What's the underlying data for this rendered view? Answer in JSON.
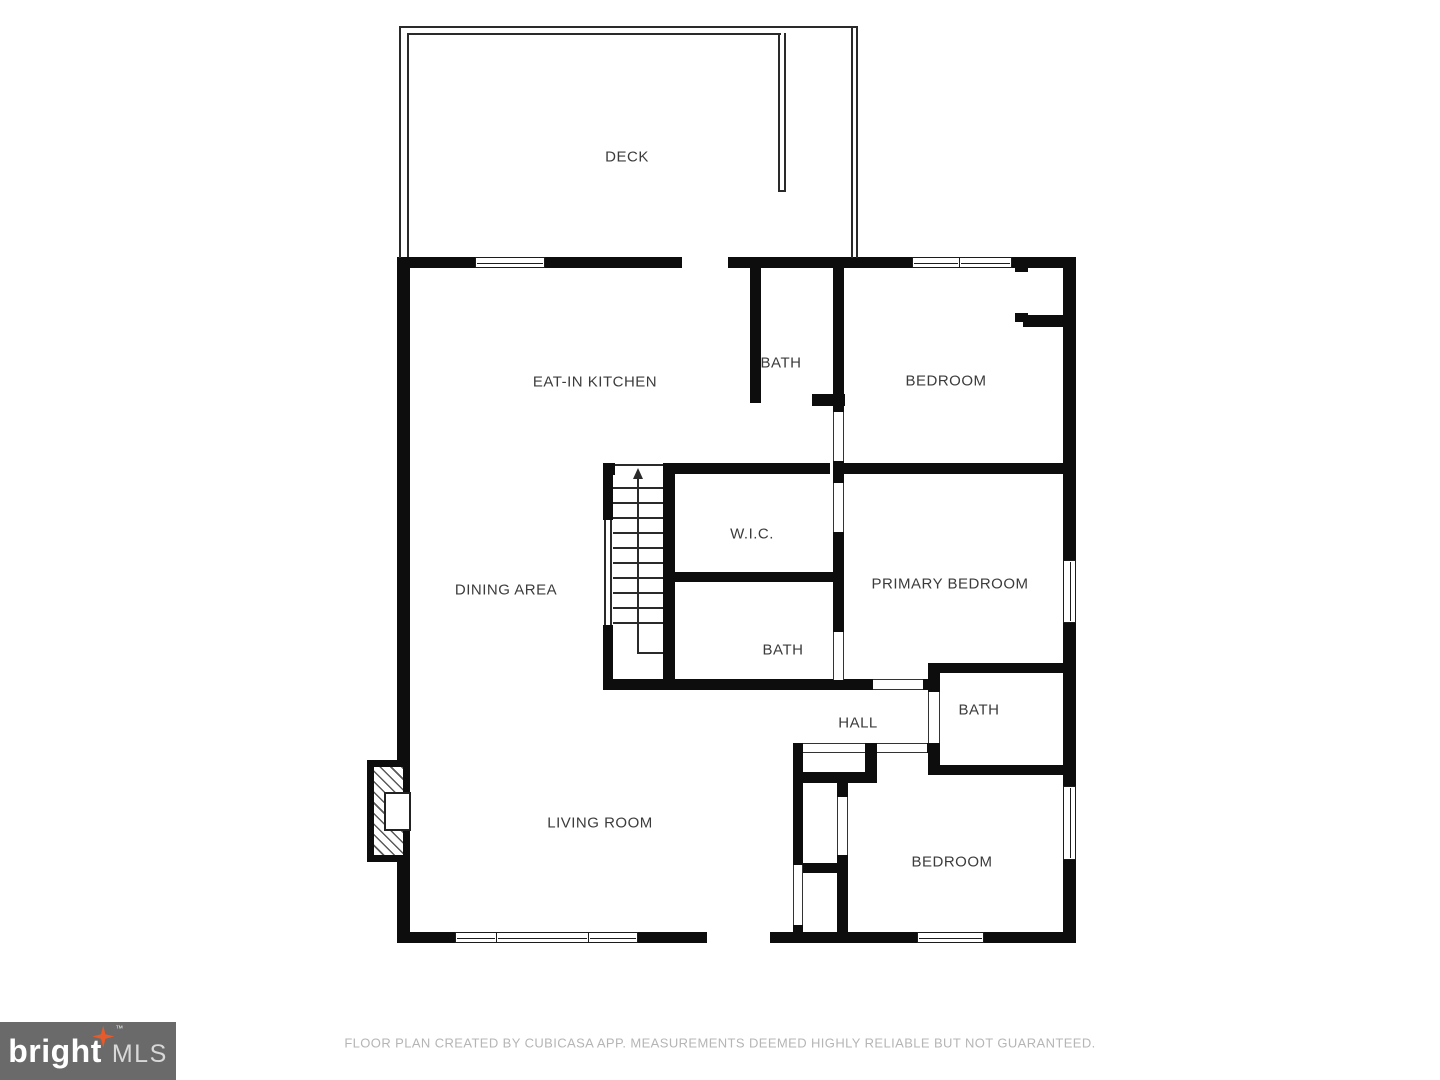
{
  "rooms": [
    {
      "id": "deck",
      "label": "DECK"
    },
    {
      "id": "eat-in-kitchen",
      "label": "EAT-IN KITCHEN"
    },
    {
      "id": "bath-top",
      "label": "BATH"
    },
    {
      "id": "bedroom-top",
      "label": "BEDROOM"
    },
    {
      "id": "wic",
      "label": "W.I.C."
    },
    {
      "id": "dining-area",
      "label": "DINING AREA"
    },
    {
      "id": "primary-bedroom",
      "label": "PRIMARY BEDROOM"
    },
    {
      "id": "bath-middle",
      "label": "BATH"
    },
    {
      "id": "hall",
      "label": "HALL"
    },
    {
      "id": "bath-right",
      "label": "BATH"
    },
    {
      "id": "living-room",
      "label": "LIVING ROOM"
    },
    {
      "id": "bedroom-bottom",
      "label": "BEDROOM"
    }
  ],
  "stairs": {
    "direction": "up"
  },
  "footer": {
    "text": "FLOOR PLAN CREATED BY CUBICASA APP. MEASUREMENTS DEEMED HIGHLY RELIABLE BUT NOT GUARANTEED."
  },
  "logo": {
    "brand": "bright",
    "suffix": "MLS",
    "tm": "™",
    "box_color": "#6a6a6a",
    "star_color": "#e85a2a"
  },
  "colors": {
    "walls": "#0d0d0d",
    "labels": "#3b3b3b",
    "footer_text": "#b5b5b5"
  }
}
